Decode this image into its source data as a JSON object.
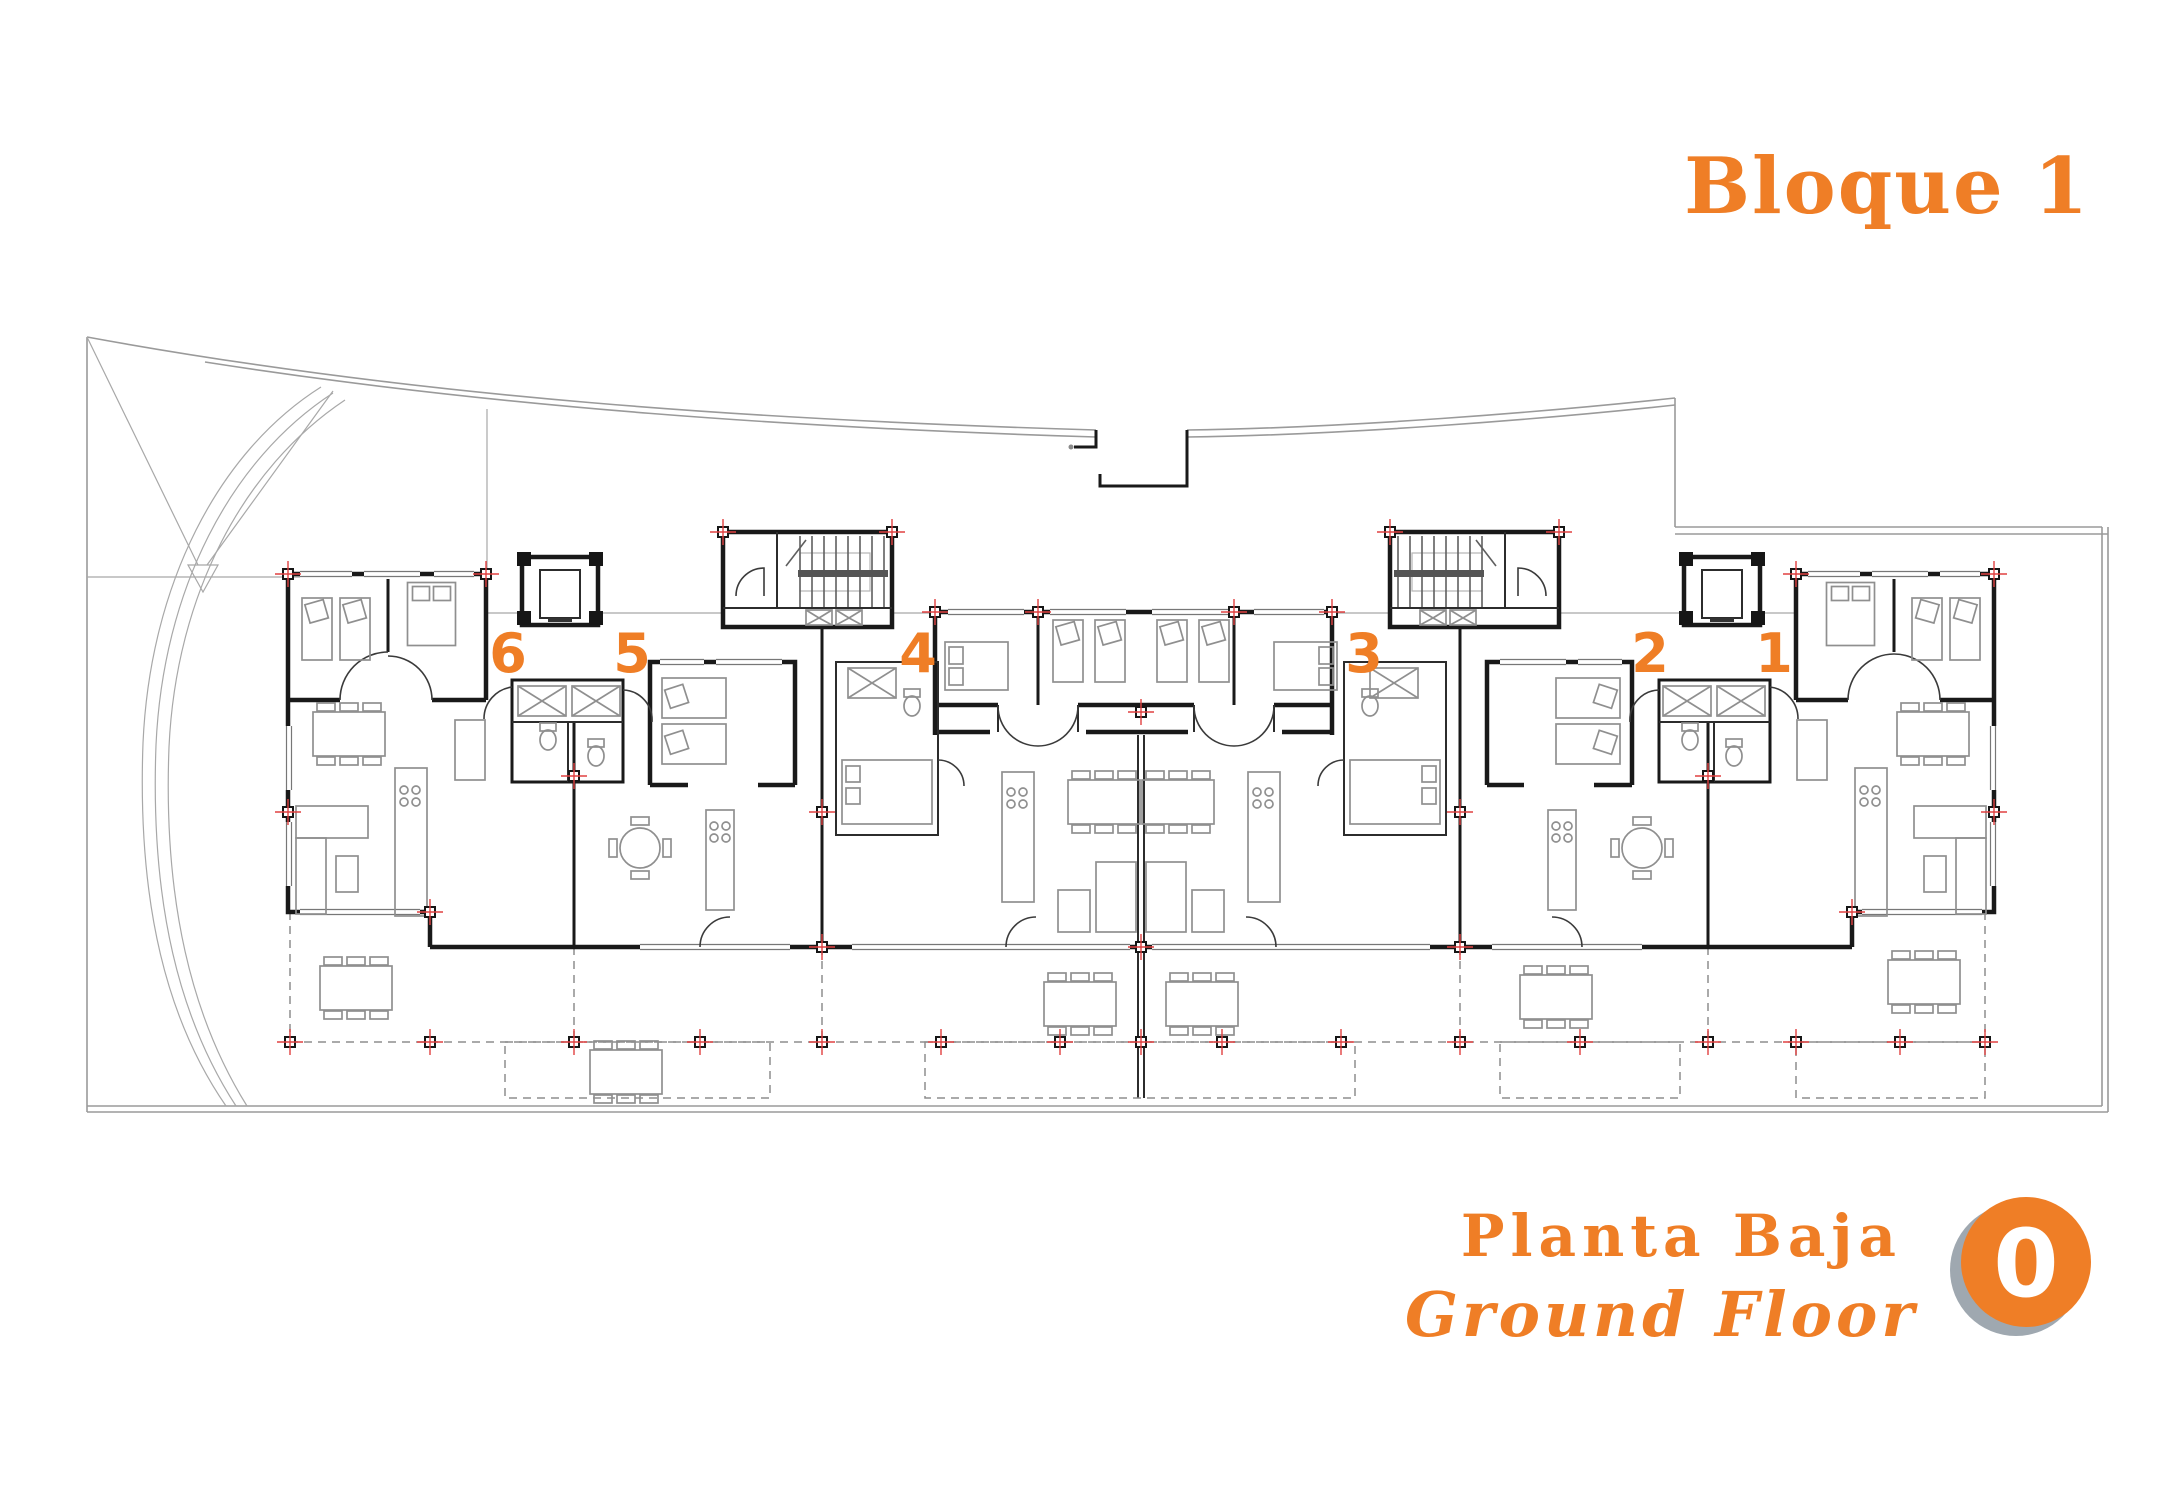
{
  "title": "Bloque 1",
  "plan": {
    "units": [
      {
        "label": "6"
      },
      {
        "label": "5"
      },
      {
        "label": "4"
      },
      {
        "label": "3"
      },
      {
        "label": "2"
      },
      {
        "label": "1"
      }
    ]
  },
  "footer": {
    "floor_es": "Planta Baja",
    "floor_en": "Ground Floor",
    "badge": "0"
  },
  "colors": {
    "accent": "#ef7e26",
    "marker_red": "#e04040",
    "wall": "#191919",
    "site_line": "#9a9a9a",
    "furniture": "#8f8f8f",
    "badge_shadow": "#9fa8b0"
  }
}
